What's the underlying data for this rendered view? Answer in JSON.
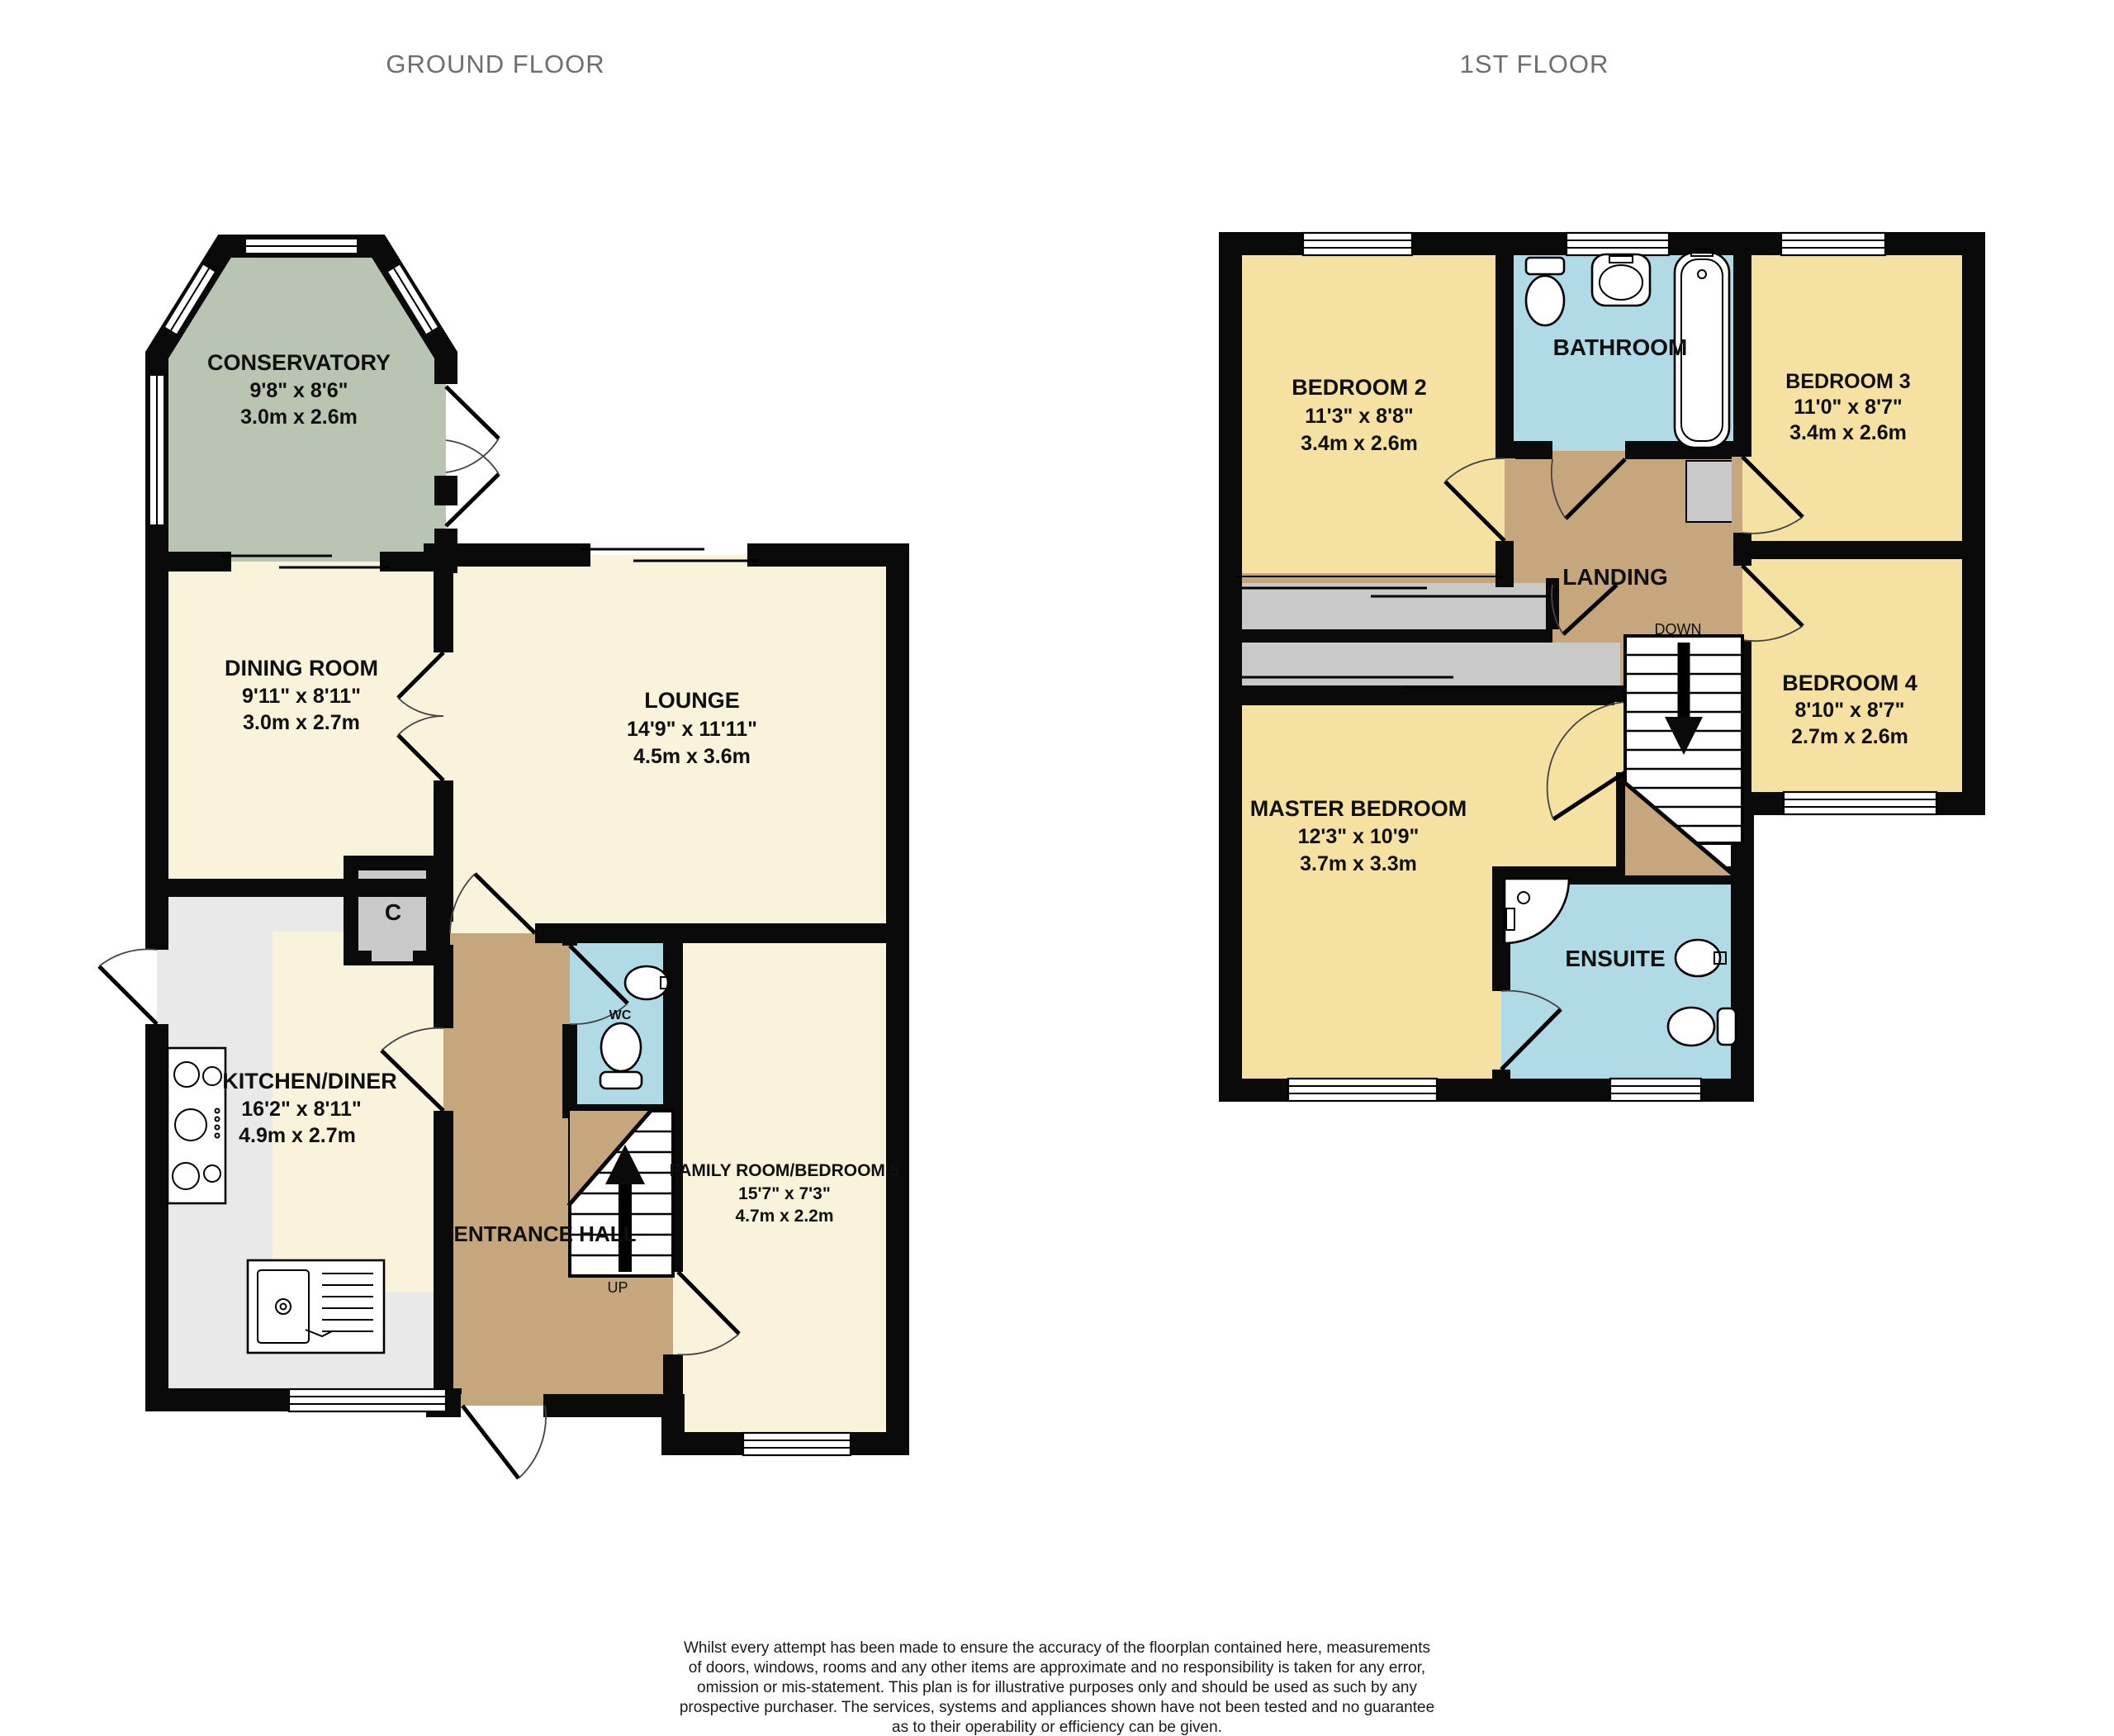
{
  "titles": {
    "ground": "GROUND FLOOR",
    "first": "1ST FLOOR"
  },
  "colors": {
    "cream": "#FAF3DC",
    "yellow": "#F5E2A2",
    "blue": "#AFDAE6",
    "brown": "#C5A67D",
    "green": "#BAC4B3",
    "grey_counter": "#E9E9E9",
    "grey_unit": "#C9C9C9",
    "wall": "#0A0A0A",
    "title_grey": "#6E6E6E"
  },
  "ground_floor": {
    "conservatory": {
      "name": "CONSERVATORY",
      "imperial": "9'8\"  x 8'6\"",
      "metric": "3.0m  x 2.6m"
    },
    "dining_room": {
      "name": "DINING ROOM",
      "imperial": "9'11\"  x 8'11\"",
      "metric": "3.0m  x 2.7m"
    },
    "lounge": {
      "name": "LOUNGE",
      "imperial": "14'9\"  x 11'11\"",
      "metric": "4.5m  x 3.6m"
    },
    "kitchen_diner": {
      "name": "KITCHEN/DINER",
      "imperial": "16'2\"  x 8'11\"",
      "metric": "4.9m  x 2.7m"
    },
    "family_room": {
      "name": "FAMILY ROOM/BEDROOM 5",
      "imperial": "15'7\"  x 7'3\"",
      "metric": "4.7m  x 2.2m"
    },
    "entrance_hall": {
      "name": "ENTRANCE HALL"
    },
    "wc": {
      "name": "WC"
    },
    "cupboard": {
      "name": "C"
    },
    "stairs": {
      "label": "UP"
    }
  },
  "first_floor": {
    "bedroom2": {
      "name": "BEDROOM 2",
      "imperial": "11'3\"  x 8'8\"",
      "metric": "3.4m  x 2.6m"
    },
    "bathroom": {
      "name": "BATHROOM"
    },
    "bedroom3": {
      "name": "BEDROOM 3",
      "imperial": "11'0\"  x 8'7\"",
      "metric": "3.4m  x 2.6m"
    },
    "bedroom4": {
      "name": "BEDROOM 4",
      "imperial": "8'10\"  x 8'7\"",
      "metric": "2.7m  x 2.6m"
    },
    "master_bedroom": {
      "name": "MASTER BEDROOM",
      "imperial": "12'3\"  x 10'9\"",
      "metric": "3.7m  x 3.3m"
    },
    "ensuite": {
      "name": "ENSUITE"
    },
    "landing": {
      "name": "LANDING"
    },
    "stairs": {
      "label": "DOWN"
    }
  },
  "footer": {
    "lines": [
      "Whilst every attempt has been made to ensure the accuracy of the floorplan contained here, measurements",
      "of doors, windows, rooms and any other items are approximate and no responsibility is taken for any error,",
      "omission or mis-statement. This plan is for illustrative purposes only and should be used as such by any",
      "prospective purchaser. The services, systems and appliances shown have not been tested and no guarantee",
      "as to their operability or efficiency can be given.",
      "Made with Metropix ©2025"
    ]
  }
}
